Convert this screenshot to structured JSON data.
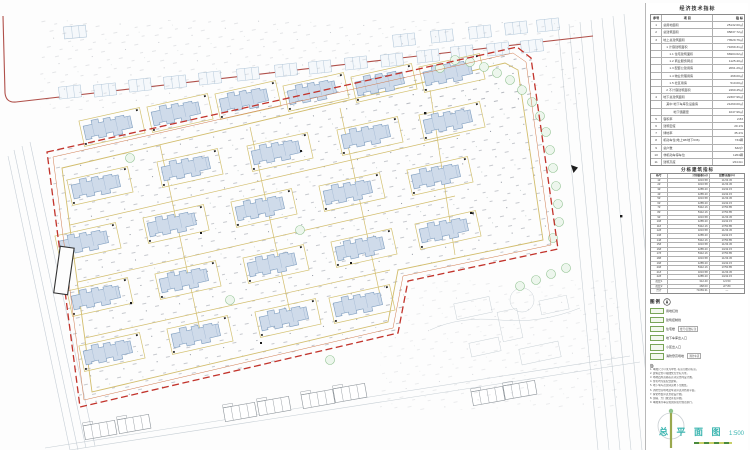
{
  "panel": {
    "econ": {
      "title": "经济技术指标",
      "header": [
        "序号",
        "项  目",
        "指  标"
      ],
      "rows": [
        {
          "n": "1",
          "label": "总用地面积",
          "value": "25132.60㎡"
        },
        {
          "n": "2",
          "label": "总建筑面积",
          "value": "95837.72㎡"
        },
        {
          "n": "3",
          "label": "地上总建筑面积",
          "value": "73529.76㎡"
        },
        {
          "n": "",
          "label": "　1 计容建筑面积",
          "value": "71069.31㎡"
        },
        {
          "n": "",
          "label": "　　1.1 住宅建筑面积",
          "value": "66904.62㎡"
        },
        {
          "n": "",
          "label": "　　1.2 商业服务网点",
          "value": "1125.40㎡"
        },
        {
          "n": "",
          "label": "　　1.3 配套公建用房",
          "value": "2061.29㎡"
        },
        {
          "n": "",
          "label": "　　1.4 物业管理用房",
          "value": "468.00㎡"
        },
        {
          "n": "",
          "label": "　　1.5 社区用房",
          "value": "510.00㎡"
        },
        {
          "n": "",
          "label": "　2 不计容建筑面积",
          "value": "2460.45㎡"
        },
        {
          "n": "4",
          "label": "地下总建筑面积",
          "value": "22307.96㎡"
        },
        {
          "n": "",
          "label": "　其中 地下车库及设备房",
          "value": "21260.00㎡"
        },
        {
          "n": "",
          "label": "　　　 地下储藏室",
          "value": "1047.96㎡"
        },
        {
          "n": "5",
          "label": "容积率",
          "value": "2.83"
        },
        {
          "n": "6",
          "label": "建筑密度",
          "value": "20.1%"
        },
        {
          "n": "7",
          "label": "绿地率",
          "value": "35.2%"
        },
        {
          "n": "8",
          "label": "机动车位(地上98/地下636)",
          "value": "734辆"
        },
        {
          "n": "9",
          "label": "总户数",
          "value": "632户"
        },
        {
          "n": "10",
          "label": "非机动车停车位",
          "value": "1264辆"
        },
        {
          "n": "11",
          "label": "建筑高度",
          "value": "≤54.0m"
        }
      ]
    },
    "unit": {
      "title": "分栋建筑指标",
      "header": [
        "栋号",
        "计容面积(㎡)",
        "层数/高度(m)"
      ],
      "rows": [
        {
          "n": "1#",
          "a": "3216.58",
          "f": "11/33.45"
        },
        {
          "n": "2#",
          "a": "3216.58",
          "f": "11/33.45"
        },
        {
          "n": "3#",
          "a": "4285.20",
          "f": "14/42.15"
        },
        {
          "n": "4#",
          "a": "4285.20",
          "f": "14/42.15"
        },
        {
          "n": "5#",
          "a": "3216.58",
          "f": "11/33.45"
        },
        {
          "n": "6#",
          "a": "4285.20",
          "f": "14/42.15"
        },
        {
          "n": "7#",
          "a": "5342.16",
          "f": "17/50.85"
        },
        {
          "n": "8#",
          "a": "5342.16",
          "f": "17/50.85"
        },
        {
          "n": "9#",
          "a": "3216.58",
          "f": "11/33.45"
        },
        {
          "n": "10#",
          "a": "4285.20",
          "f": "14/42.15"
        },
        {
          "n": "11#",
          "a": "5342.16",
          "f": "17/50.85"
        },
        {
          "n": "12#",
          "a": "3216.58",
          "f": "11/33.45"
        },
        {
          "n": "13#",
          "a": "4285.20",
          "f": "14/42.15"
        },
        {
          "n": "14#",
          "a": "5342.16",
          "f": "17/50.85"
        },
        {
          "n": "15#",
          "a": "3216.58",
          "f": "11/33.45"
        },
        {
          "n": "16#",
          "a": "4285.20",
          "f": "14/42.15"
        },
        {
          "n": "17#",
          "a": "5342.16",
          "f": "17/50.85"
        },
        {
          "n": "18#",
          "a": "3216.58",
          "f": "11/33.45"
        },
        {
          "n": "19#",
          "a": "4285.20",
          "f": "14/42.15"
        },
        {
          "n": "20#",
          "a": "5342.16",
          "f": "17/50.85"
        },
        {
          "n": "21#",
          "a": "3216.58",
          "f": "11/33.45"
        },
        {
          "n": "22#",
          "a": "4285.20",
          "f": "14/42.15"
        },
        {
          "n": "配套1",
          "a": "312.40",
          "f": "1/4.50"
        },
        {
          "n": "配套2",
          "a": "468.00",
          "f": "2/7.80"
        },
        {
          "n": "合计",
          "a": "71069.31",
          "f": "—"
        }
      ]
    },
    "legend": {
      "title": "图例",
      "items": [
        {
          "label": "用地红线",
          "extra": ""
        },
        {
          "label": "建筑控制线",
          "extra": ""
        },
        {
          "label": "住宅楼",
          "extra": "楼号/层数标注"
        },
        {
          "label": "地下车库出入口",
          "extra": ""
        },
        {
          "label": "小区出入口",
          "extra": ""
        },
        {
          "label": "消防登高场地",
          "extra": "消防车道"
        }
      ]
    },
    "notes": {
      "title": "注:",
      "lines": [
        "1. 本图尺寸以米为单位, 标高为绝对标高。",
        "2. 建筑定位以轴线交点坐标为准。",
        "3. 场地四周道路标高详见竖向设计图。",
        "4. 住宅均为装配式建筑。",
        "5. 地下车库范围详见地下室图纸。",
        "6. 消防登高场地及车道详见消防总平面。",
        "7. 绿化布置详见景观设计图。",
        "8. 围墙、大门做法详见详图。",
        "9. 本图未尽事宜按国家现行规范执行。"
      ]
    },
    "title_block": {
      "title": "总 平 面 图",
      "scale": "1:500"
    }
  }
}
